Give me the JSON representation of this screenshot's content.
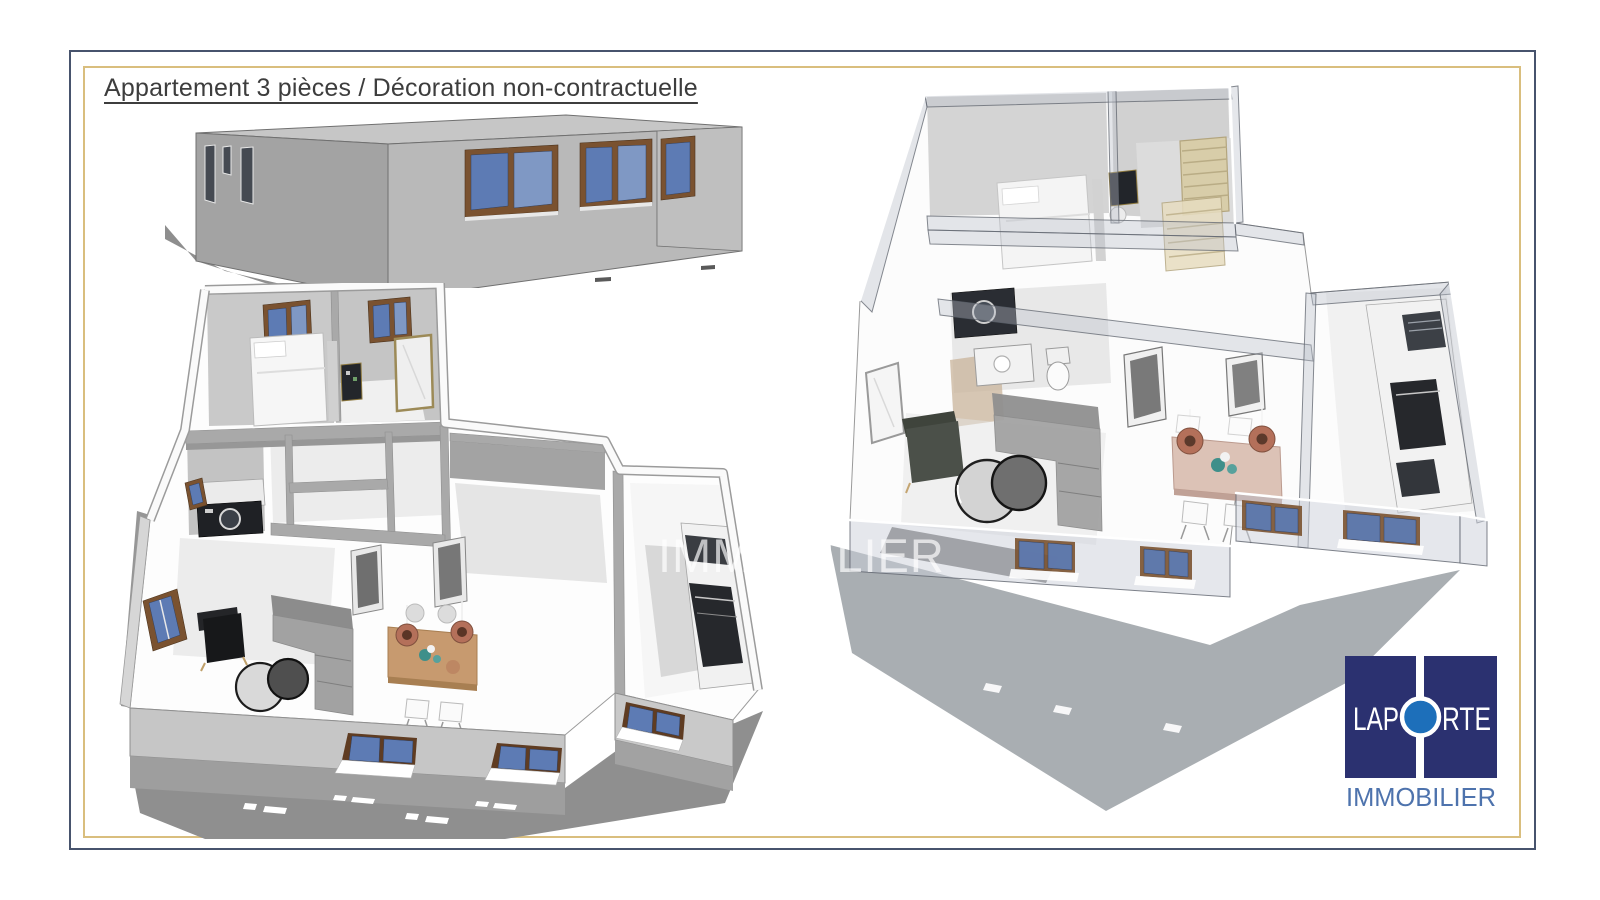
{
  "title": "Appartement 3 pièces / Décoration non-contractuelle",
  "watermark": "IMMOBILIER",
  "logo": {
    "word_left": "LAP",
    "word_right": "RTE",
    "tagline": "IMMOBILIER"
  },
  "colors": {
    "frame_outer": "#47536d",
    "frame_inner": "#d9be7e",
    "title_text": "#3d3d3d",
    "logo_navy": "#2b3170",
    "logo_circle_blue": "#1d6fba",
    "logo_tagline_blue": "#4e73ad",
    "window_blue": "#5d7bb4",
    "window_frame_brown": "#7a5230",
    "wood_table": "#c79a6f",
    "copper_lamp": "#b4705a",
    "wall_gray": "#aaaaaa",
    "watermark_white": "#ffffff"
  }
}
